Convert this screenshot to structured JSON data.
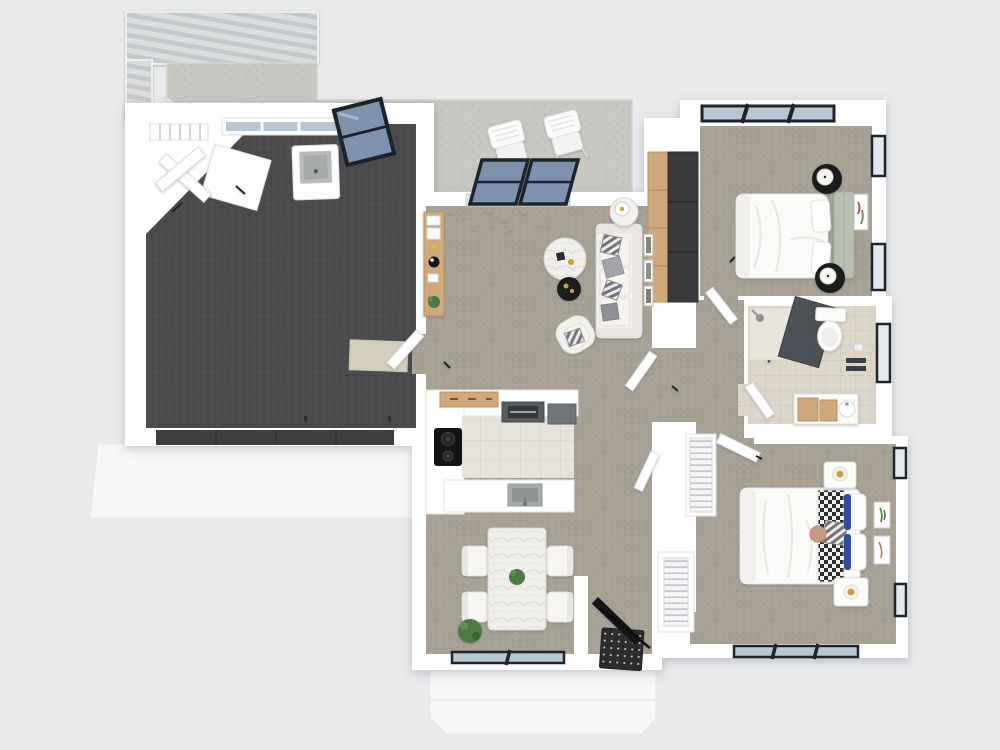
{
  "scene": {
    "kind": "3d-floor-plan-render",
    "view": "top-down-dollhouse",
    "rooms": [
      {
        "name": "garage",
        "floor": "dark charcoal carpet",
        "items": [
          "utility-sink",
          "laundry-door",
          "laundry-door",
          "storage-cabinet",
          "threshold-mat",
          "garage-door",
          "driveway"
        ]
      },
      {
        "name": "pergola-deck",
        "floor": "slatted louvre roof",
        "items": [
          "shrub-ball"
        ]
      },
      {
        "name": "patio",
        "floor": "concrete",
        "items": [
          "outdoor-chair",
          "outdoor-chair",
          "sliding-glass-door",
          "glazed-door-ajar"
        ]
      },
      {
        "name": "living-room",
        "floor": "beige carpet",
        "items": [
          "sofa",
          "armchair",
          "marble-coffee-table",
          "black-accent-table",
          "side-table-with-lamp",
          "wood-console",
          "wall-art-frames"
        ]
      },
      {
        "name": "kitchen",
        "floor": "white tile",
        "items": [
          "cooktop",
          "range-with-hood",
          "upper-cabinets",
          "appliance",
          "peninsula-sink"
        ]
      },
      {
        "name": "dining-area",
        "floor": "beige carpet",
        "items": [
          "marble-dining-table",
          "dining-chair",
          "dining-chair",
          "dining-chair",
          "dining-chair",
          "centerpiece-plant",
          "floor-plant",
          "window"
        ]
      },
      {
        "name": "entry",
        "floor": "beige carpet",
        "items": [
          "black-front-door",
          "patterned-doormat",
          "porch",
          "wire-shelf-closet"
        ]
      },
      {
        "name": "hallway",
        "floor": "beige carpet",
        "items": [
          "wardrobe-dark-sliding-panels",
          "wire-shelf-linen-closet",
          "white-doors"
        ]
      },
      {
        "name": "bathroom",
        "floor": "beige tile",
        "items": [
          "glass-shower",
          "toilet",
          "towel-rail",
          "toilet-paper-holder",
          "vanity-wood-drawers",
          "window"
        ]
      },
      {
        "name": "bedroom-1",
        "floor": "beige carpet",
        "items": [
          "double-bed",
          "sage-headboard-bench",
          "black-round-nightstand",
          "black-round-nightstand",
          "white-lamp",
          "white-lamp",
          "wall-art",
          "window-band",
          "side-windows"
        ]
      },
      {
        "name": "bedroom-2",
        "floor": "beige carpet",
        "items": [
          "double-bed",
          "checkered-runner",
          "diamond-pillow",
          "navy-trim-pillows",
          "white-nightstand",
          "white-nightstand",
          "brass-lamp",
          "brass-lamp",
          "round-stool",
          "wall-art",
          "wall-art",
          "windows"
        ]
      }
    ]
  },
  "palette": {
    "bg": "#e9eaec",
    "wall": "#ffffff",
    "garage_floor": "#4b4b4d",
    "carpet": "#a8a296",
    "concrete": "#c9c7c2",
    "tile_white": "#e6e3dc",
    "tile_beige": "#dcd6c8",
    "glass": "#b9c6d4",
    "glass_slider": "#7d92ac",
    "frame_dark": "#1d242c",
    "wood": "#cfa87b",
    "wood_dark": "#3a3a3c",
    "sage": "#b9c0b1",
    "white_soft": "#f2f1ed",
    "charcoal": "#1f1f1f",
    "navy": "#2f4f96",
    "brass": "#c9a23f",
    "green": "#4c7a44",
    "marble": "#f1efeb",
    "mat_dark": "#2c2c2c",
    "door_black": "#141414",
    "outdoor_slab": "#f7f8f8"
  }
}
